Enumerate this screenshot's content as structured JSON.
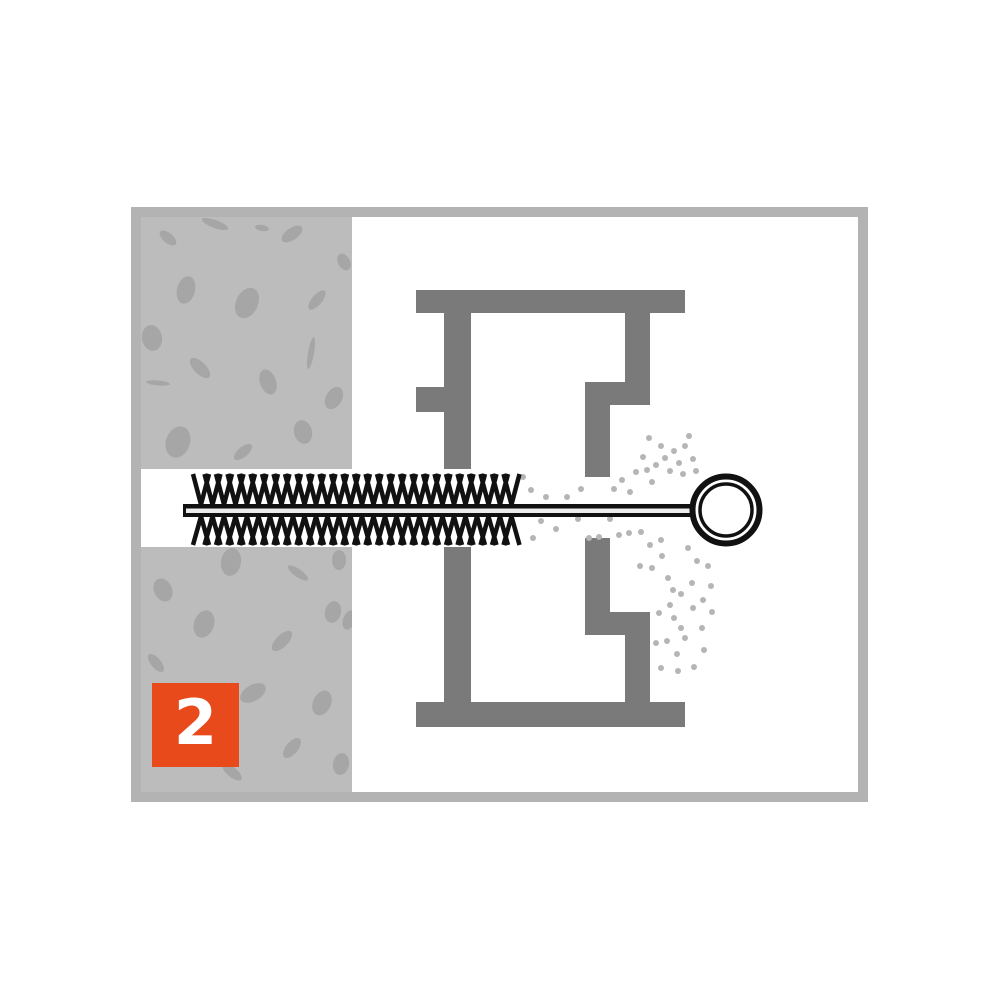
{
  "colors": {
    "background": "#ffffff",
    "frame_border": "#b3b3b3",
    "concrete": "#bcbcbc",
    "fleck": "#a6a6a6",
    "block": "#7a7a7a",
    "dust": "#b5b5b5",
    "brush": "#111111",
    "rod_core": "#ececec",
    "badge_bg": "#e84a1c",
    "badge_text": "#ffffff"
  },
  "badge": {
    "number": "2",
    "x": 152,
    "y": 683,
    "w": 87,
    "h": 84
  },
  "frame": {
    "x": 131,
    "y": 207,
    "w": 737,
    "h": 595,
    "thickness": 10
  },
  "concrete": {
    "x": 141,
    "y": 217,
    "w": 211,
    "h": 575,
    "flecks": [
      [
        168,
        238,
        10,
        5,
        40
      ],
      [
        215,
        224,
        14,
        4,
        20
      ],
      [
        292,
        234,
        12,
        6,
        -35
      ],
      [
        344,
        262,
        9,
        6,
        60
      ],
      [
        262,
        228,
        7,
        3,
        10
      ],
      [
        186,
        290,
        9,
        14,
        15
      ],
      [
        247,
        303,
        11,
        16,
        25
      ],
      [
        317,
        300,
        12,
        5,
        -50
      ],
      [
        152,
        338,
        10,
        13,
        -10
      ],
      [
        200,
        368,
        13,
        6,
        45
      ],
      [
        268,
        382,
        8,
        13,
        -20
      ],
      [
        158,
        383,
        12,
        2.5,
        5
      ],
      [
        311,
        353,
        3,
        16,
        10
      ],
      [
        334,
        398,
        8,
        12,
        30
      ],
      [
        178,
        442,
        12,
        16,
        20
      ],
      [
        243,
        452,
        11,
        5,
        -40
      ],
      [
        303,
        432,
        9,
        12,
        -15
      ],
      [
        231,
        562,
        10,
        14,
        10
      ],
      [
        298,
        573,
        12,
        4,
        35
      ],
      [
        163,
        590,
        9,
        12,
        -25
      ],
      [
        204,
        624,
        10,
        14,
        20
      ],
      [
        282,
        641,
        13,
        6,
        -45
      ],
      [
        333,
        612,
        8,
        11,
        15
      ],
      [
        156,
        663,
        11,
        5,
        50
      ],
      [
        253,
        693,
        14,
        8,
        -30
      ],
      [
        322,
        703,
        9,
        13,
        25
      ],
      [
        292,
        748,
        12,
        6,
        -50
      ],
      [
        341,
        764,
        8,
        11,
        10
      ],
      [
        232,
        772,
        12,
        5,
        40
      ],
      [
        172,
        712,
        9,
        6,
        -20
      ],
      [
        339,
        560,
        7,
        10,
        0
      ],
      [
        349,
        620,
        6,
        10,
        20
      ]
    ]
  },
  "channel": {
    "x": 141,
    "y": 469,
    "w": 211,
    "h": 78
  },
  "block": {
    "rects": [
      [
        416,
        290,
        269,
        23
      ],
      [
        416,
        702,
        269,
        25
      ],
      [
        444,
        313,
        27,
        156
      ],
      [
        444,
        547,
        27,
        155
      ],
      [
        416,
        387,
        28,
        25
      ],
      [
        625,
        313,
        25,
        92
      ],
      [
        585,
        382,
        65,
        23
      ],
      [
        585,
        382,
        25,
        95
      ],
      [
        585,
        538,
        25,
        97
      ],
      [
        585,
        612,
        65,
        23
      ],
      [
        625,
        612,
        25,
        90
      ]
    ]
  },
  "brush": {
    "bristles": {
      "x_start": 193,
      "count": 28,
      "step": 11.5,
      "v_width": 16,
      "top": 474,
      "bottom": 545,
      "rod_top": 504.5,
      "rod_bottom": 516.5,
      "stroke": 4.5
    },
    "rod": {
      "x1": 183,
      "x2": 690,
      "y": 504,
      "h": 13,
      "core_inset": 3,
      "core_y": 508.5,
      "core_h": 4.5
    }
  },
  "ring": {
    "cx": 726,
    "cy": 510,
    "outer_r": 33.5,
    "outer_stroke": 6,
    "inner_r": 26,
    "inner_stroke": 3.5
  },
  "dust": {
    "r": 3,
    "points": [
      [
        523,
        477
      ],
      [
        531,
        490
      ],
      [
        546,
        497
      ],
      [
        567,
        497
      ],
      [
        581,
        489
      ],
      [
        614,
        489
      ],
      [
        622,
        480
      ],
      [
        630,
        492
      ],
      [
        636,
        472
      ],
      [
        643,
        457
      ],
      [
        647,
        470
      ],
      [
        652,
        482
      ],
      [
        656,
        465
      ],
      [
        661,
        446
      ],
      [
        665,
        458
      ],
      [
        670,
        471
      ],
      [
        674,
        451
      ],
      [
        679,
        463
      ],
      [
        685,
        446
      ],
      [
        683,
        474
      ],
      [
        649,
        438
      ],
      [
        689,
        436
      ],
      [
        693,
        459
      ],
      [
        696,
        471
      ],
      [
        533,
        538
      ],
      [
        541,
        521
      ],
      [
        556,
        529
      ],
      [
        578,
        519
      ],
      [
        589,
        538
      ],
      [
        599,
        537
      ],
      [
        610,
        519
      ],
      [
        619,
        535
      ],
      [
        629,
        533
      ],
      [
        641,
        532
      ],
      [
        650,
        545
      ],
      [
        661,
        540
      ],
      [
        640,
        566
      ],
      [
        652,
        568
      ],
      [
        662,
        556
      ],
      [
        668,
        578
      ],
      [
        673,
        590
      ],
      [
        681,
        594
      ],
      [
        692,
        583
      ],
      [
        697,
        561
      ],
      [
        688,
        548
      ],
      [
        670,
        605
      ],
      [
        659,
        613
      ],
      [
        674,
        618
      ],
      [
        681,
        628
      ],
      [
        693,
        608
      ],
      [
        703,
        600
      ],
      [
        711,
        586
      ],
      [
        656,
        643
      ],
      [
        667,
        641
      ],
      [
        677,
        654
      ],
      [
        685,
        638
      ],
      [
        704,
        650
      ],
      [
        661,
        668
      ],
      [
        678,
        671
      ],
      [
        694,
        667
      ],
      [
        702,
        628
      ],
      [
        712,
        612
      ],
      [
        708,
        566
      ]
    ]
  }
}
